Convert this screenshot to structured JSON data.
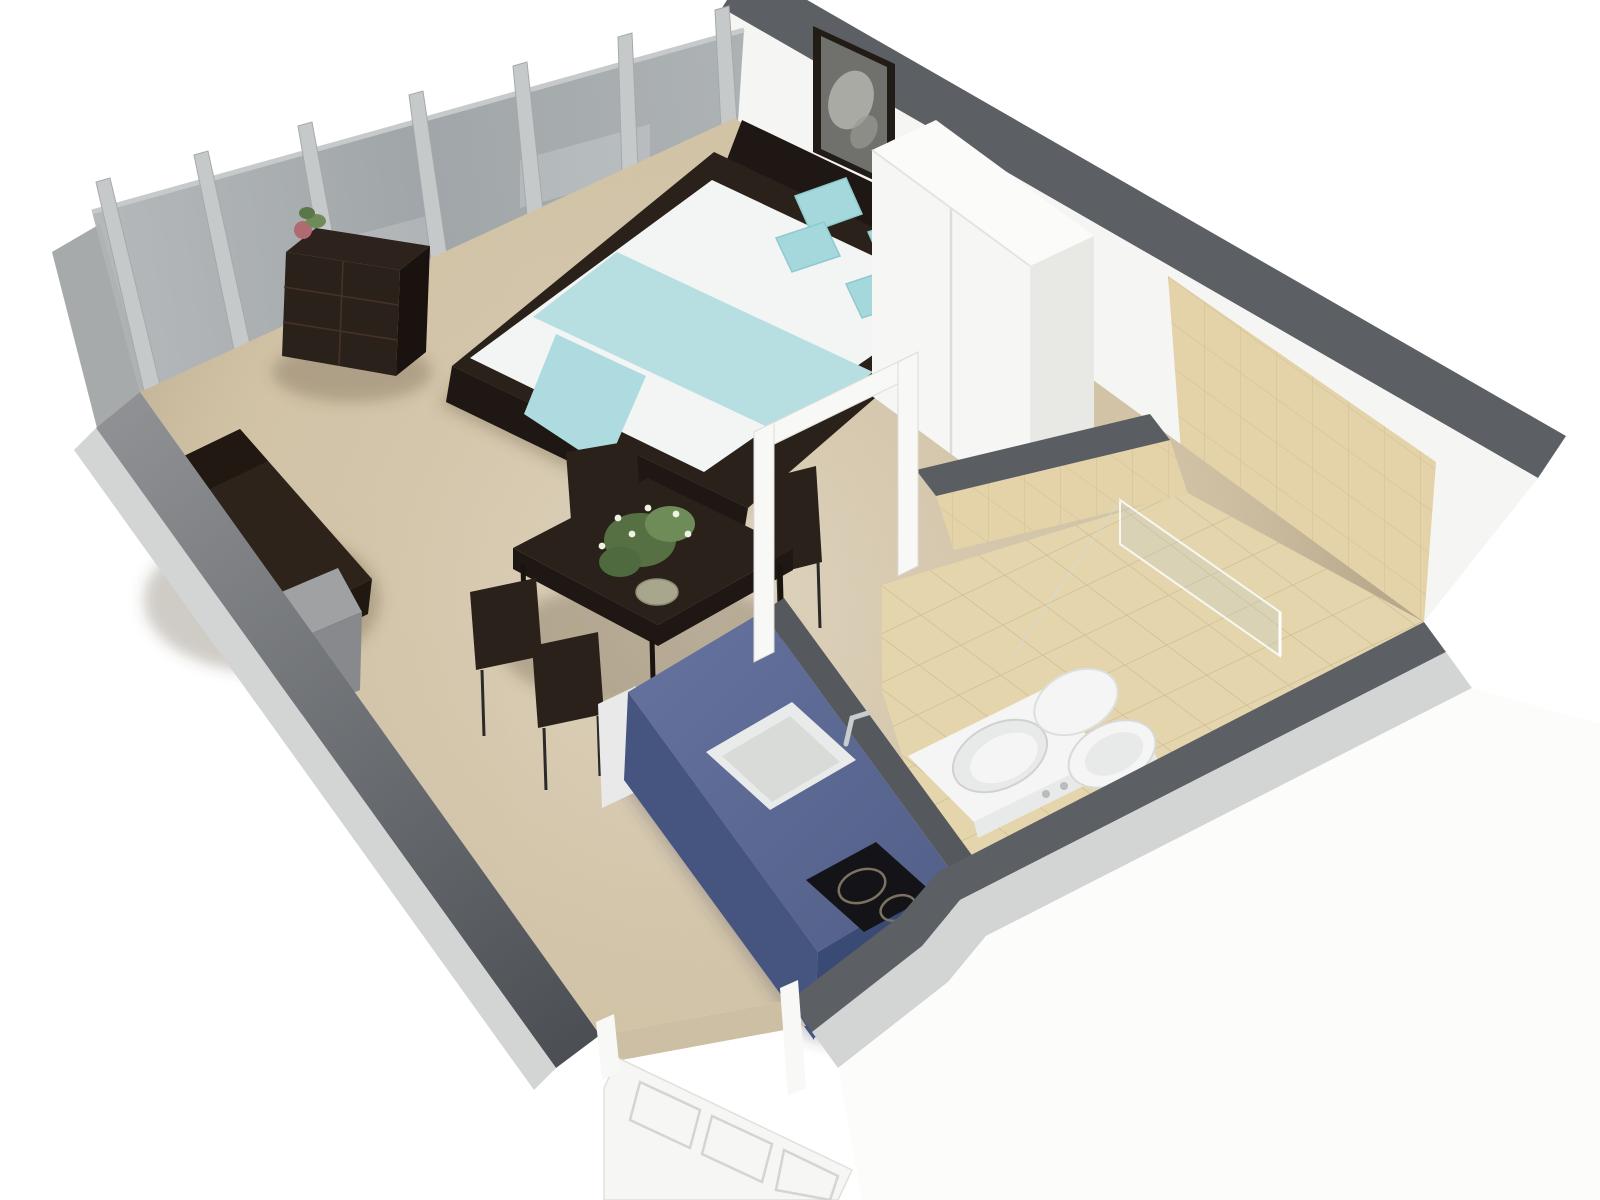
{
  "scene": {
    "type": "isometric-3d-floor-plan",
    "rooms": [
      "living-bedroom-area",
      "kitchen-area",
      "bathroom"
    ],
    "elements": [
      "glass-balcony-wall",
      "double-bed",
      "aqua-pillows",
      "aqua-blanket",
      "headboard",
      "wall-art",
      "wardrobe",
      "nightstand",
      "cube-shelf",
      "shelf-plant",
      "sofa",
      "side-table",
      "dining-table",
      "dining-chairs",
      "table-plant",
      "kitchen-island",
      "kitchen-sink",
      "faucet",
      "cooktop",
      "interior-door-frame",
      "divider-wall",
      "bathroom-vanity",
      "toilet",
      "shower-glass",
      "entry-door",
      "tiled-bathroom-floor",
      "carpet-floor"
    ]
  },
  "colors": {
    "background": "#ffffff",
    "carpet": "#d5c7ab",
    "tile_floor": "#e5d5ad",
    "tile_wall": "#e4d2a8",
    "wall_white": "#f5f5f3",
    "wall_outer_white": "#fcfcfb",
    "wall_top_dark": "#5c6064",
    "wall_top_light": "#d3d4d4",
    "glass": "#a2a7aa",
    "glass_sill": "#b9bcbd",
    "glass_post": "#c6c9c9",
    "corner_wedge": "#a7aaab",
    "wood_dark": "#2a211a",
    "wood_darker": "#1e1713",
    "shelf_top": "#2e231c",
    "shelf_side": "#1a120e",
    "sofa": "#2d231a",
    "sofa_back": "#201811",
    "mattress": "#f3f5f4",
    "blanket": "#b7dfe2",
    "blanket_tail": "#aedbdf",
    "pillow": "#a5d8dc",
    "wardrobe": "#f6f6f4",
    "wardrobe_side": "#e8e8e5",
    "wardrobe_top": "#fbfbf9",
    "nightstand": "#f2f2ef",
    "nightstand_side": "#e9e9e6",
    "island_top": "#5e6b94",
    "island_front": "#46557f",
    "island_side": "#394a74",
    "island_ledge": "#55595d",
    "end_cabinet": "#e8e9e8",
    "sink": "#e9eaea",
    "basin": "#d9dbd8",
    "cooktop": "#141418",
    "burner_ring": "#7c7260",
    "fixture": "#f4f5f4",
    "fixture_shade": "#e8eae9",
    "door": "#f6f6f4",
    "door_frame": "#f8f8f6",
    "threshold": "#cdbfa4",
    "side_table_top": "#9fa1a3",
    "side_table_front": "#87898c",
    "side_table_side": "#74767a",
    "divider_band": "#5a5e62",
    "plant_green": "#5a7748",
    "plant_green_light": "#6e8c58",
    "plant_green_dark": "#4e6a3e",
    "flower_white": "#eef2e2",
    "pot": "#a8a68c",
    "shelf_flower_pink": "#b06a72",
    "frame_dark": "#221c17",
    "frame_image": "#70706c",
    "frame_image_light": "#b9b9b4",
    "shadow": "rgba(80,66,48,0.28)",
    "island_shadow": "rgba(60,62,84,0.25)"
  }
}
